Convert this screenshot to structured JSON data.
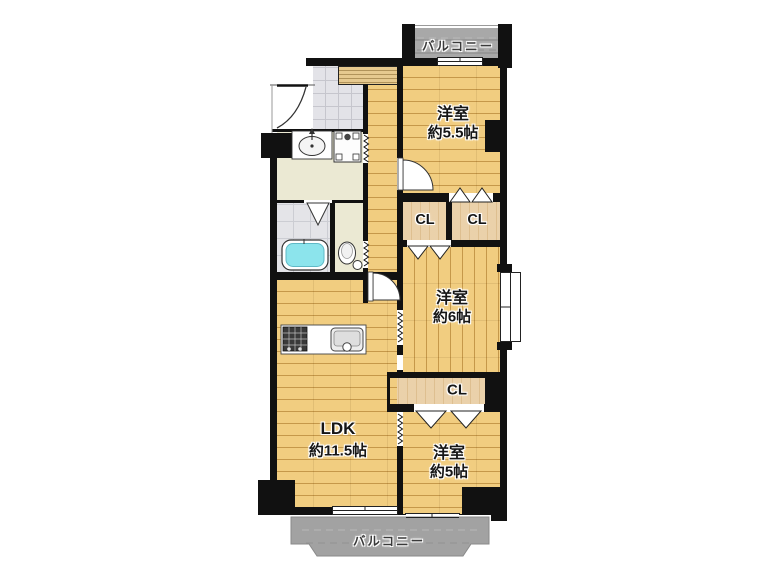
{
  "balconies": {
    "top": "バルコニー",
    "bottom": "バルコニー"
  },
  "rooms": {
    "bedroom_a": {
      "name": "洋室",
      "size": "約5.5帖"
    },
    "bedroom_b": {
      "name": "洋室",
      "size": "約6帖"
    },
    "bedroom_c": {
      "name": "洋室",
      "size": "約5帖"
    },
    "ldk": {
      "name": "LDK",
      "size": "約11.5帖"
    }
  },
  "closets": {
    "a": "CL",
    "b": "CL",
    "c": "CL"
  },
  "colors": {
    "wood": "#ecc36e",
    "closet_tan": "#e7c99b",
    "balcony_gray": "#a2a2a2",
    "bathtub_cyan": "#8ce4ec",
    "wall_black": "#111111"
  }
}
